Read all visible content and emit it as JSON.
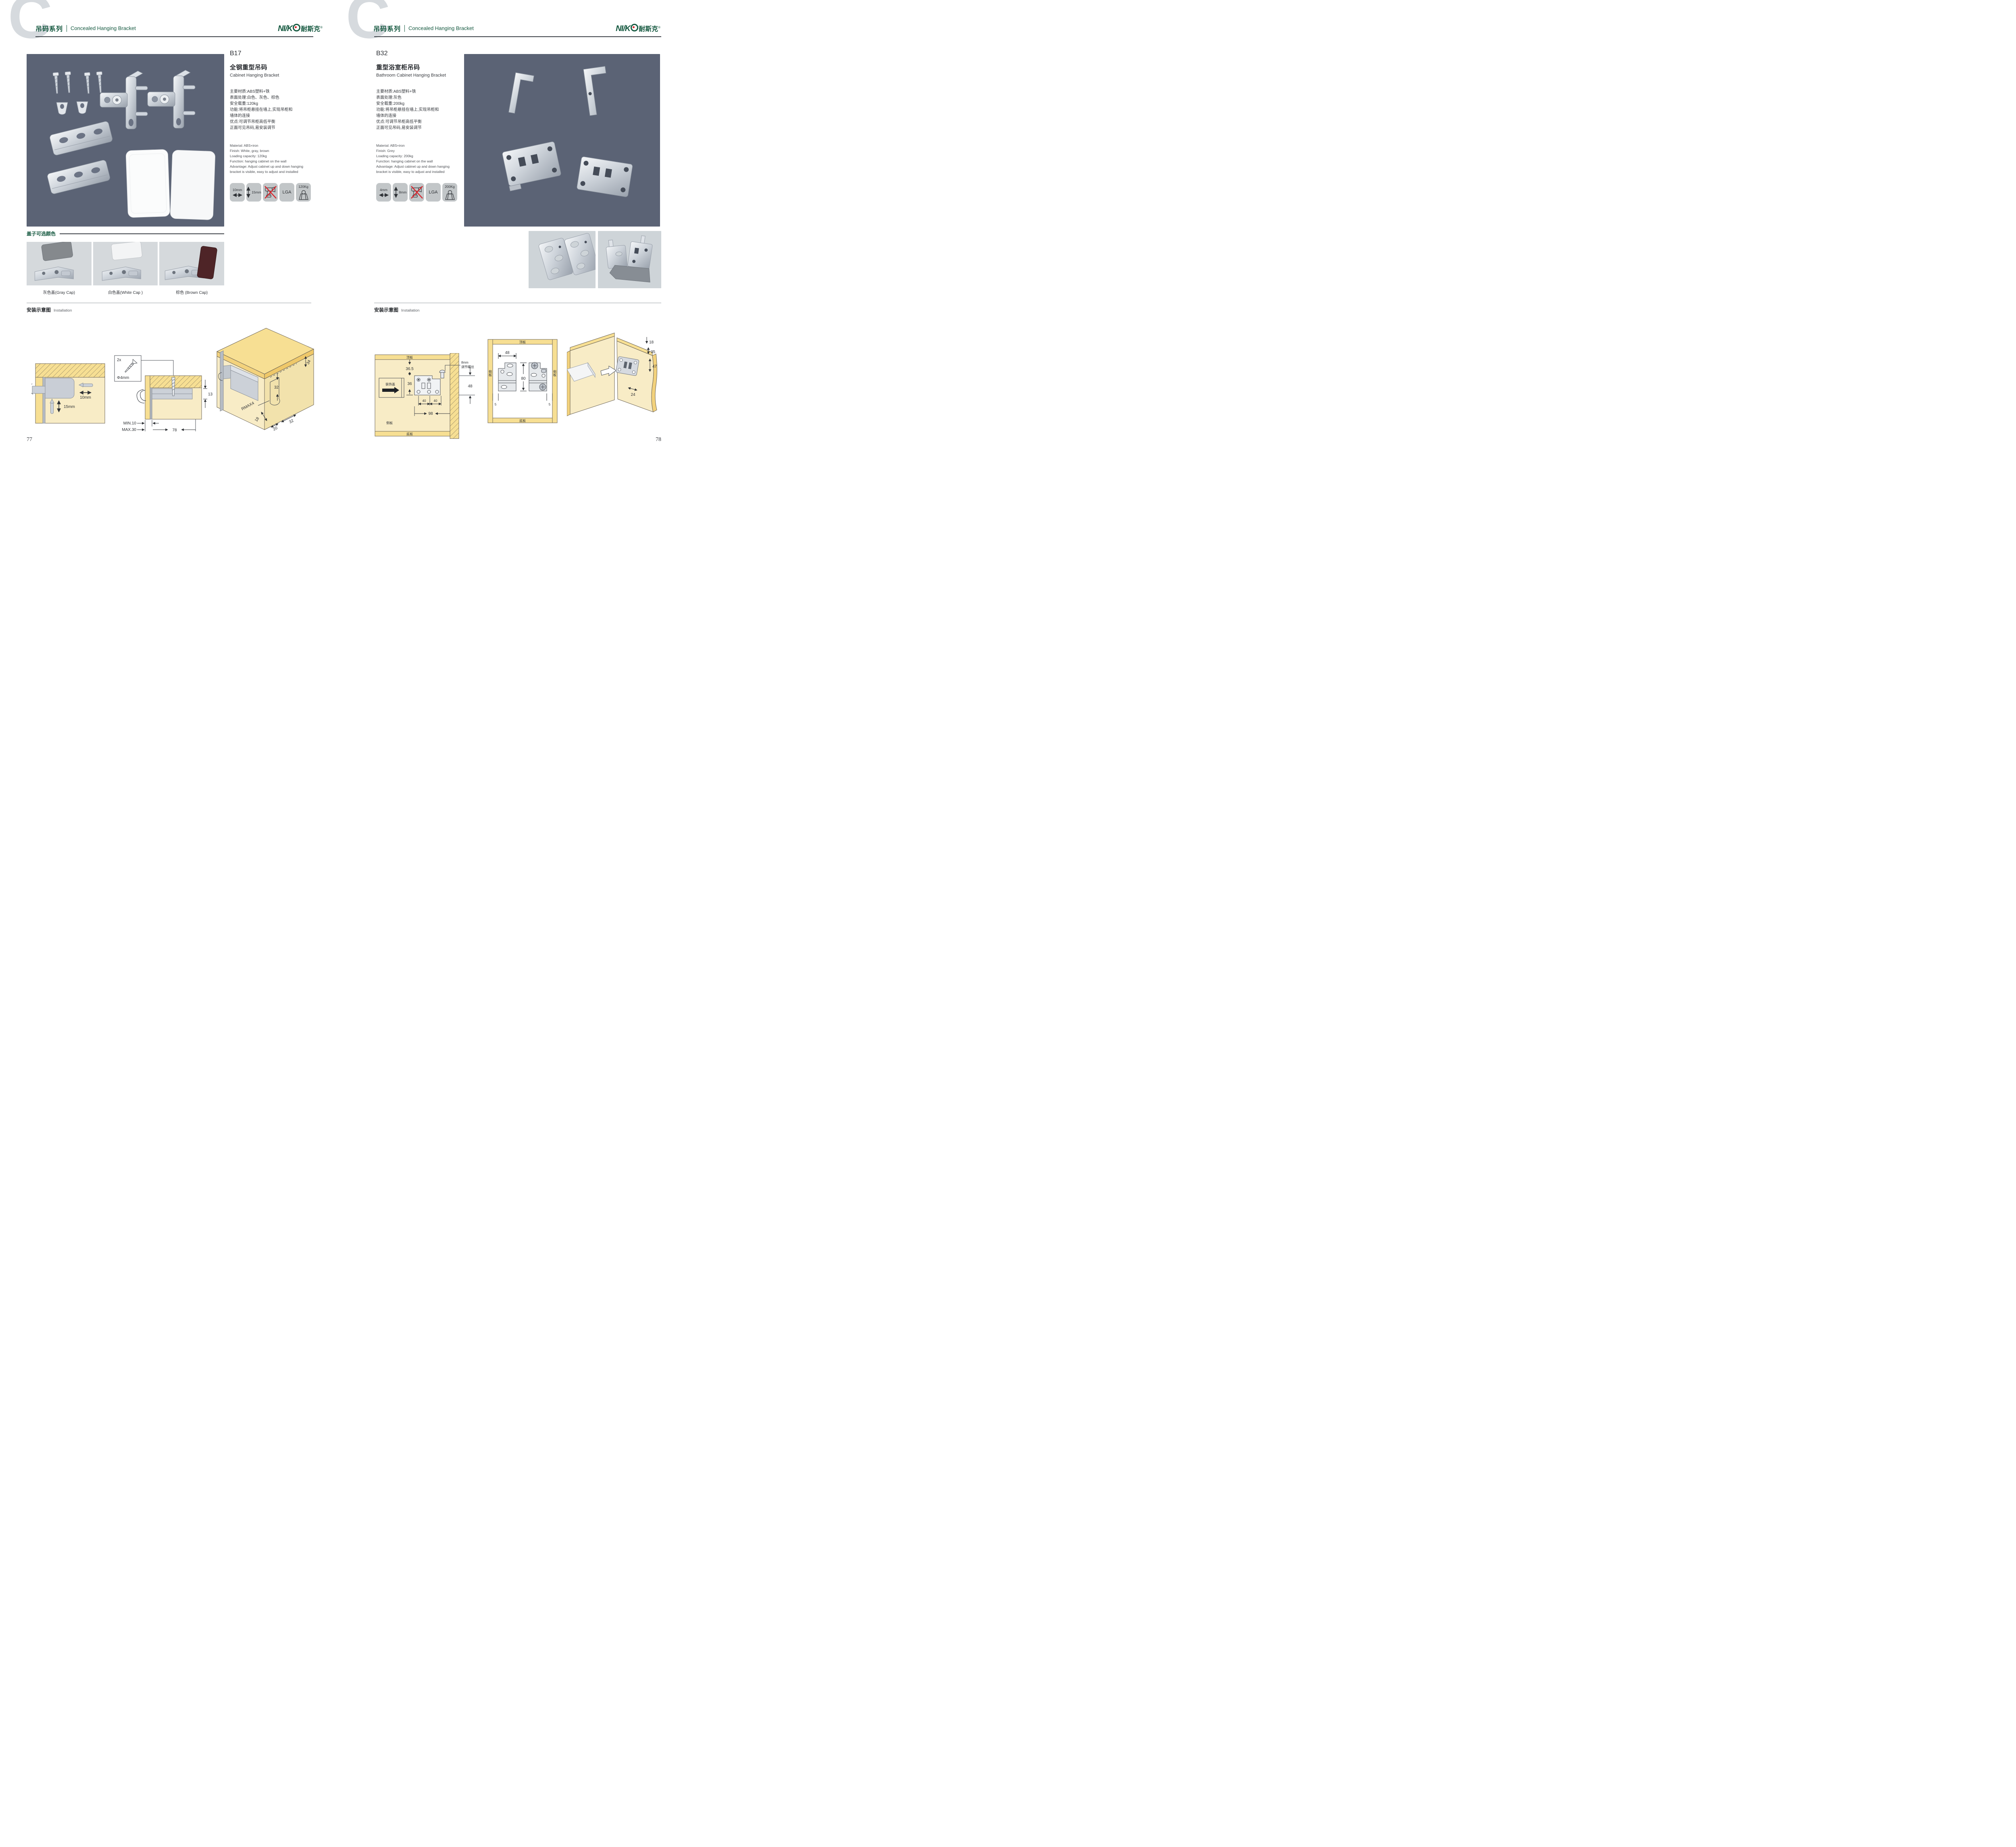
{
  "colors": {
    "brand_green": "#14583f",
    "photo_bg": "#5b6375",
    "badge_bg": "#c2c6c8",
    "light_photo_bg": "#d5d9dc",
    "wood_face": "#f8ecc6",
    "wood_edge": "#f7df93",
    "alert_red": "#d8272e",
    "rule_dark": "#3b4046"
  },
  "header": {
    "watermark": "C",
    "series_cn": "吊码系列",
    "series_en": "Concealed Hanging Bracket"
  },
  "brand": {
    "logo_en": "NI/K",
    "logo_cn": "耐斯克",
    "reg": "®"
  },
  "left_page": {
    "page_number": "77",
    "product": {
      "code": "B17",
      "name_cn": "全钢重型吊码",
      "name_en": "Cabinet Hanging Bracket",
      "specs_cn": [
        "主要材质:ABS塑料+铁",
        "表面处理:白色、灰色、棕色",
        "安全载重:120kg",
        "功能:将吊柜悬挂在墙上,实现吊柜和",
        "墙体的连接",
        "优点:可调节吊柜高低平衡",
        "正面可见吊码,易安装调节"
      ],
      "specs_en": [
        "Material: ABS+iron",
        "Finish: White, gray, brown",
        "Loading capacity: 120kg",
        "Function: hanging cabinet on the wall",
        "Advantage: Adjust cabinet up and down hanging",
        "bracket is visible, easy to adjust and installed"
      ],
      "badges": [
        {
          "label": "10mm",
          "icon": "width-arrow"
        },
        {
          "label": "15mm",
          "icon": "height-arrow"
        },
        {
          "label": "",
          "icon": "no-drill"
        },
        {
          "label": "LGA",
          "icon": "lga-cert"
        },
        {
          "label": "120Kg",
          "icon": "max-load"
        }
      ]
    },
    "cap_colors": {
      "heading": "盖子可选颜色",
      "items": [
        {
          "label": "灰色盖(Gray Cap)",
          "cap_color": "#85898d"
        },
        {
          "label": "白色盖(White Cap )",
          "cap_color": "#f3f4f5"
        },
        {
          "label": "棕色 (Brown Cap)",
          "cap_color": "#4e2427"
        }
      ]
    },
    "installation": {
      "heading_cn": "安装示意图",
      "heading_en": "Installation",
      "diag_a": {
        "dim_width": "10mm",
        "dim_height": "15mm"
      },
      "diag_b": {
        "qty": "2x",
        "dia": "Φ4mm",
        "thickness": "13",
        "min": "MIN.10",
        "max": "MAX.30",
        "span": "78"
      },
      "diag_c": {
        "offset": "34",
        "pitch": "32",
        "radius": "RMAX4",
        "depth": "18",
        "inset": "20",
        "spacing": "32"
      }
    }
  },
  "right_page": {
    "page_number": "78",
    "product": {
      "code": "B32",
      "name_cn": "重型浴室柜吊码",
      "name_en": "Bathroom Cabinet Hanging Bracket",
      "specs_cn": [
        "主要材质:ABS塑料+铁",
        "表面处理:灰色",
        "安全载重:200kg",
        "功能:将吊柜悬挂在墙上,实现吊柜和",
        "墙体的连接",
        "优点:可调节吊柜高低平衡",
        "正面可见吊码,易安装调节"
      ],
      "specs_en": [
        "Material: ABS+iron",
        "Finish: Grey",
        "Loading capacity: 200kg",
        "Function: hanging cabinet on the wall",
        "Advantage: Adjust cabinet up and down hanging",
        "bracket is visible, easy to adjust and installed"
      ],
      "badges": [
        {
          "label": "4mm",
          "icon": "width-arrow"
        },
        {
          "label": "8mm",
          "icon": "height-arrow"
        },
        {
          "label": "",
          "icon": "no-drill"
        },
        {
          "label": "LGA",
          "icon": "lga-cert"
        },
        {
          "label": "200Kg",
          "icon": "max-load"
        }
      ]
    },
    "installation": {
      "heading_cn": "安装示意图",
      "heading_en": "Installation",
      "diag_d": {
        "top_panel": "顶板",
        "cover": "装饰盖",
        "gap_top": "36.5",
        "bracket_h": "36",
        "hole_a": "40",
        "hole_b": "40",
        "span": "98",
        "side_panel": "侧板",
        "bottom_panel": "底板",
        "screw_l1": "8mm",
        "screw_l2": "调节螺丝",
        "wall_dim": "48"
      },
      "diag_e": {
        "top_panel": "顶板",
        "side_left": "侧板",
        "side_right": "侧板",
        "bottom_panel": "底板",
        "width": "48",
        "height": "80",
        "edge_left": "5",
        "edge_right": "5"
      },
      "diag_f": {
        "d18": "18",
        "d35": "35",
        "d47": "47",
        "d24": "24"
      }
    }
  }
}
